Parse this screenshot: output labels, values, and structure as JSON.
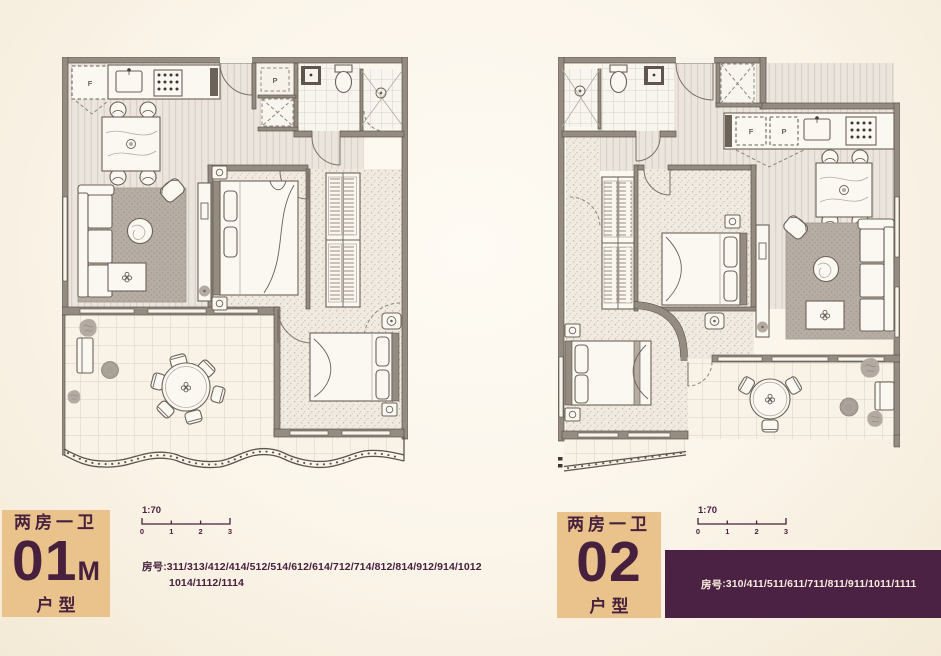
{
  "colors": {
    "card_tan": "#e9c38b",
    "plum_text": "#47203e",
    "banner_purple": "#4b2144",
    "wall_gray": "#948b81",
    "page_cream": "#fbf5ea"
  },
  "unit_left": {
    "type_label": "两房一卫",
    "code": "01",
    "code_suffix": "M",
    "category_label": "户型",
    "scale_label": "1:70",
    "scale_ticks": [
      "0",
      "1",
      "2",
      "3"
    ],
    "rooms_prefix": "房号",
    "rooms_line1": ":311/313/412/414/512/514/612/614/712/714/812/814/912/914/1012",
    "rooms_line2": "1014/1112/1114"
  },
  "unit_right": {
    "type_label": "两房一卫",
    "code": "02",
    "code_suffix": "",
    "category_label": "户型",
    "scale_label": "1:70",
    "scale_ticks": [
      "0",
      "1",
      "2",
      "3"
    ],
    "rooms_prefix": "房号",
    "rooms_line1": ":310/411/511/611/711/811/911/1011/1111"
  },
  "plan_left": {
    "fridge_label": "F",
    "pantry_label": "P"
  },
  "plan_right": {
    "fridge_label": "F",
    "pantry_label": "P"
  }
}
